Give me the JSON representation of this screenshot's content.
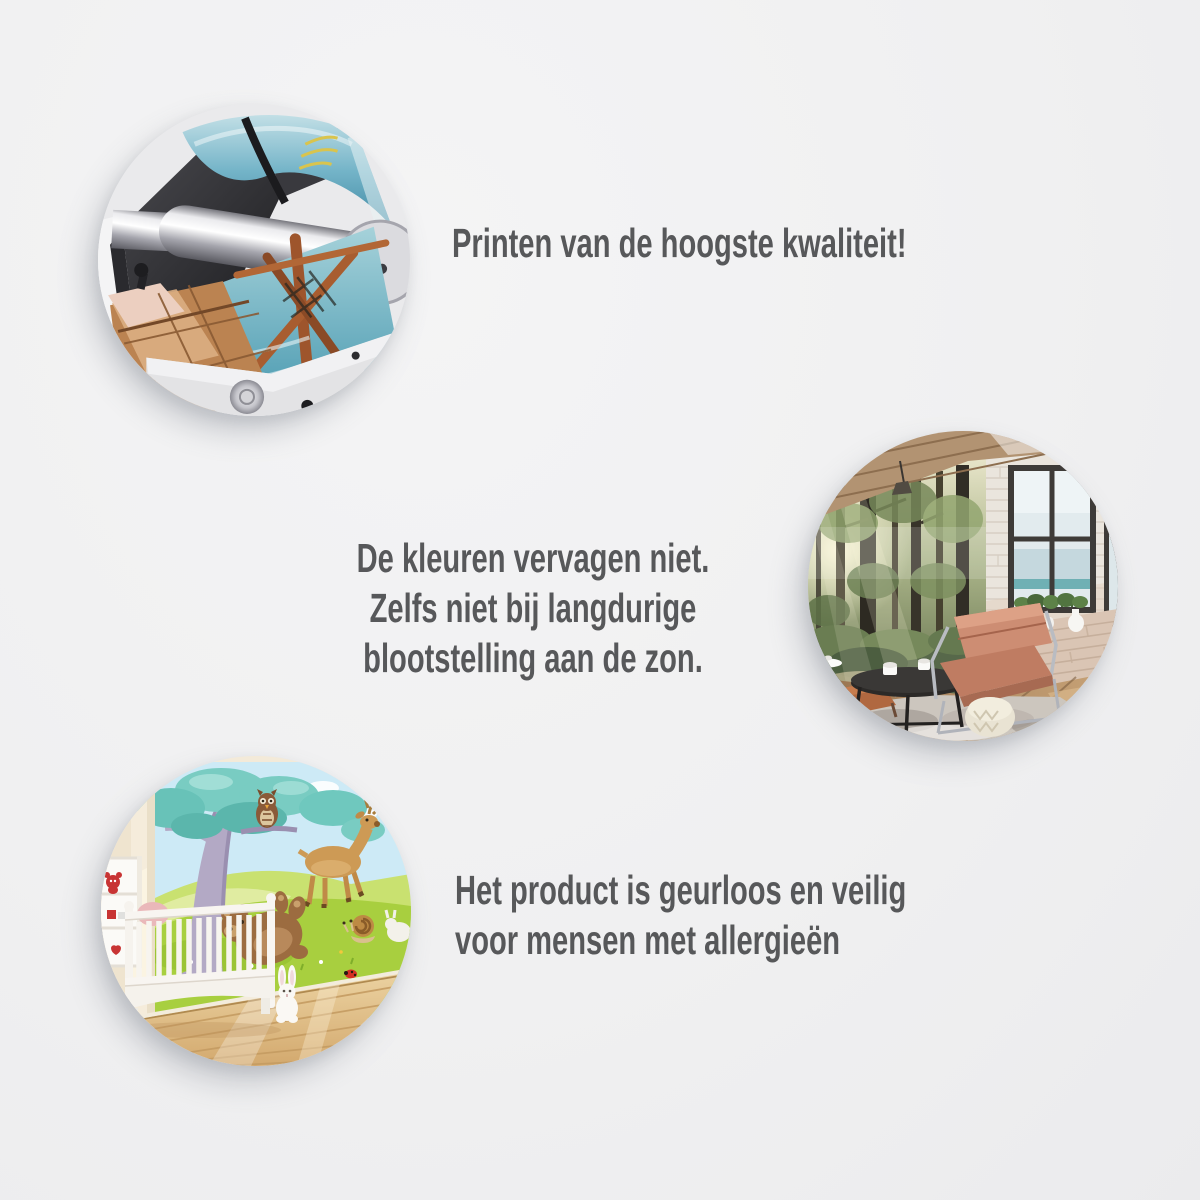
{
  "page": {
    "background_color": "#f0f0f1",
    "text_color": "#57585a"
  },
  "features": [
    {
      "id": "print-quality",
      "image": "printing-machine-photo",
      "lines": [
        "Printen van de hoogste kwaliteit!"
      ]
    },
    {
      "id": "colorfast",
      "image": "living-room-with-forest-wall-mural-photo",
      "lines": [
        "De kleuren vervagen niet.",
        "Zelfs niet bij langdurige",
        "blootstelling aan de zon."
      ]
    },
    {
      "id": "odorless-allergy-safe",
      "image": "nursery-with-cartoon-animals-wall-mural-photo",
      "lines": [
        "Het product is geurloos en veilig",
        "voor mensen met allergieën"
      ]
    }
  ]
}
